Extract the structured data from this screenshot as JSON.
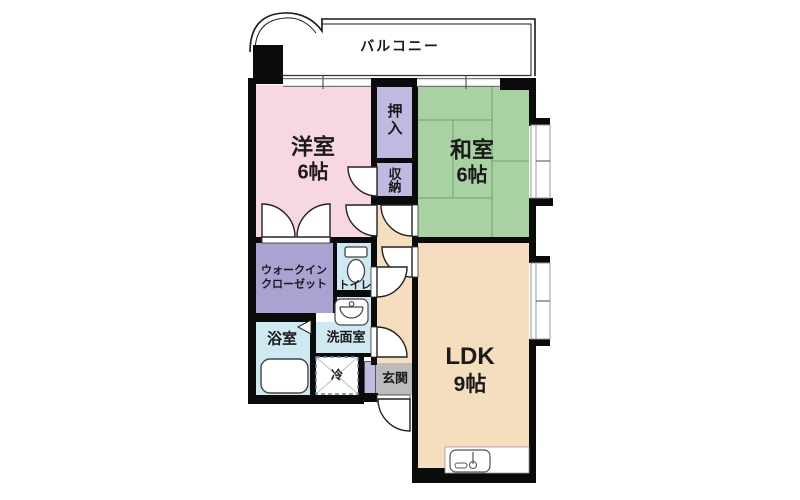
{
  "plan": {
    "type": "apartment-floor-plan",
    "rooms": {
      "balcony": {
        "label": "バルコニー"
      },
      "western_room": {
        "label": "洋室",
        "size": "6帖"
      },
      "closet_oshiire": {
        "label": "押入"
      },
      "closet_shuno": {
        "label": "収納"
      },
      "japanese_room": {
        "label": "和室",
        "size": "6帖"
      },
      "ldk": {
        "label": "LDK",
        "size": "9帖"
      },
      "walk_in_closet": {
        "label_line1": "ウォークイン",
        "label_line2": "クローゼット"
      },
      "toilet": {
        "label": "トイレ"
      },
      "bathroom": {
        "label": "浴室"
      },
      "washroom": {
        "label": "洗面室"
      },
      "refrigerator_space": {
        "label": "冷"
      },
      "entrance": {
        "label": "玄関"
      }
    },
    "icons": {
      "toilet_icon": "toilet bowl with tank",
      "sink_icon": "wash basin",
      "bathtub_icon": "bathtub",
      "kitchen_sink_icon": "kitchen counter with sink and faucet",
      "door_arc_icon": "door swing quarter circle",
      "window_icon": "double-line window with tick"
    },
    "colors": {
      "western_room": "#f8d7e5",
      "closet": "#c0b9e0",
      "walk_in_closet": "#aaa2d1",
      "japanese_room": "#a9d2a3",
      "tatami_line": "#7da87a",
      "ldk_and_hall": "#f4debd",
      "wet_area": "#cfe9f2",
      "entrance": "#bcbcbc",
      "wall": "#0b0b0b",
      "fridge_dash_border": "#5f8aa3"
    }
  }
}
